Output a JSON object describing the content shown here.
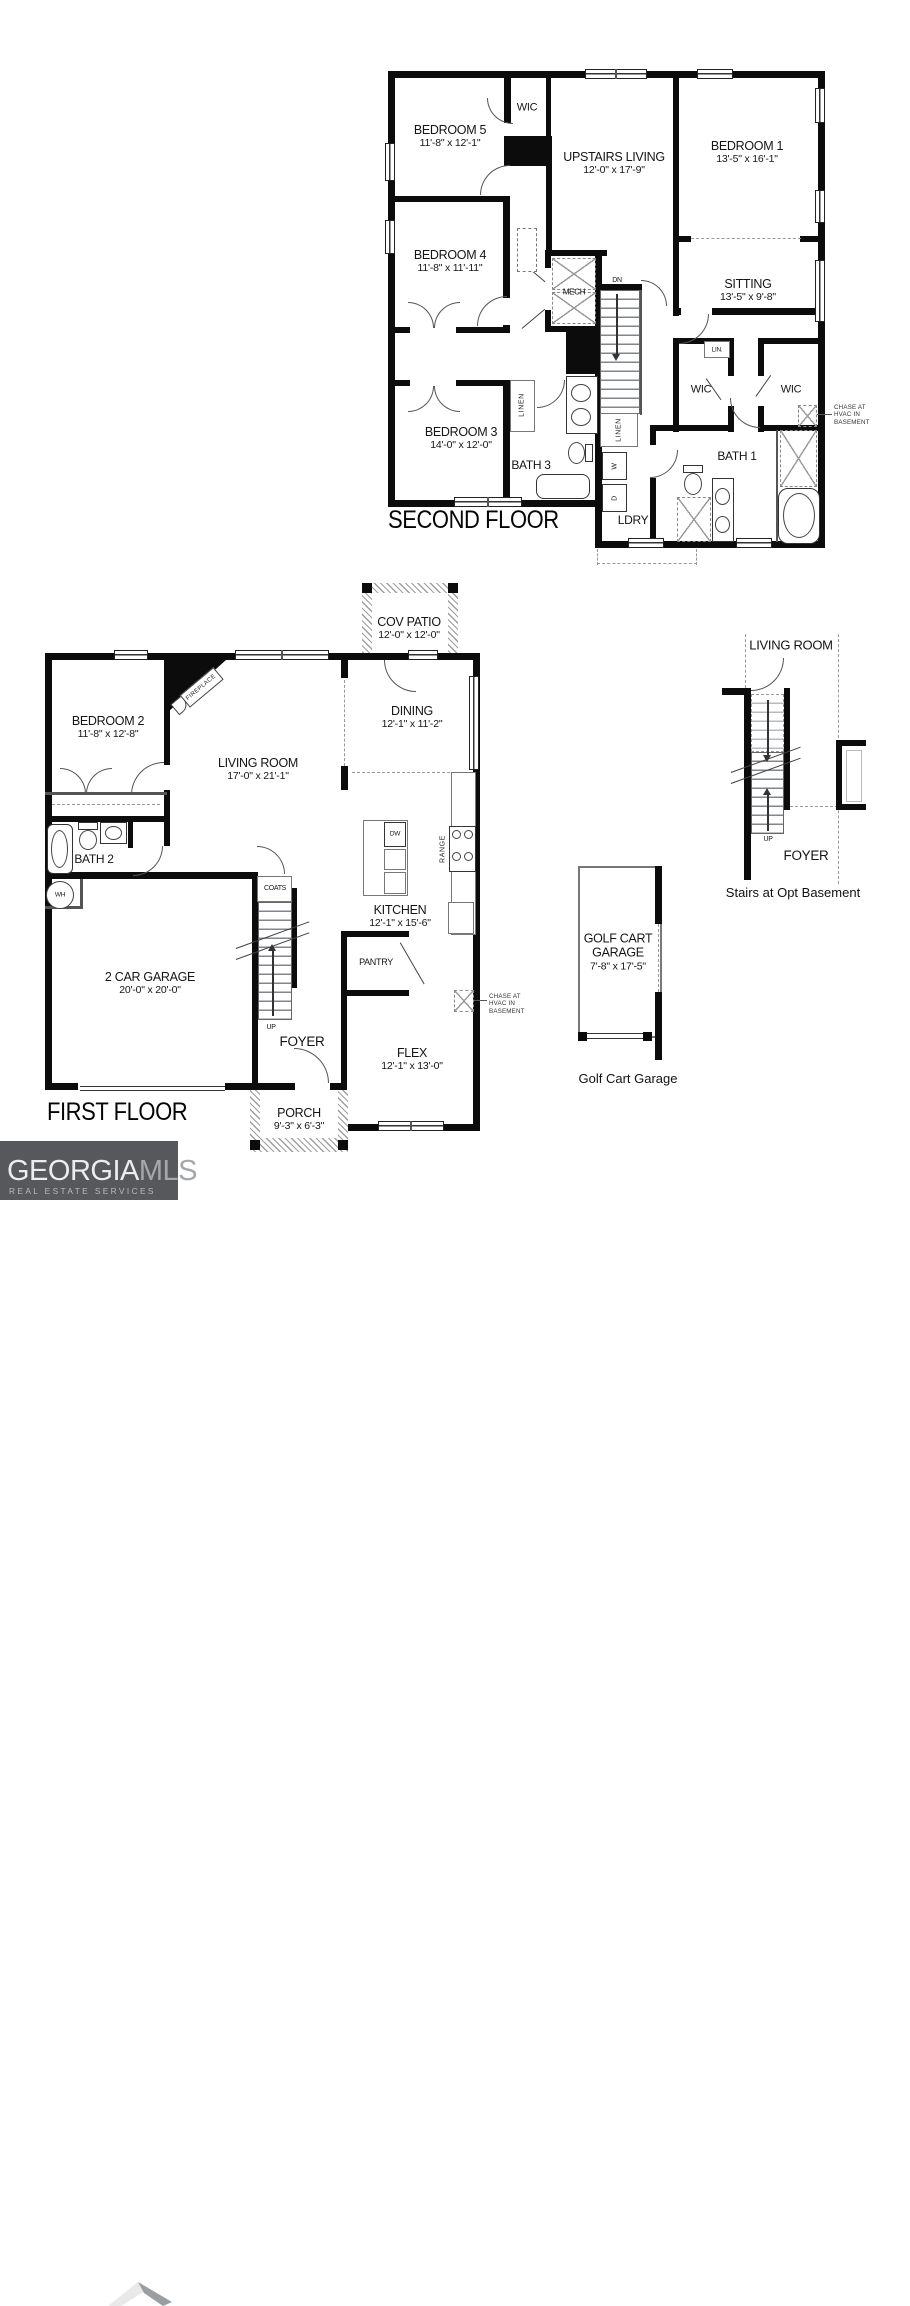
{
  "sf": {
    "title": "SECOND FLOOR",
    "bed5": "BEDROOM 5",
    "bed5_d": "11'-8\" x 12'-1\"",
    "wic": "WIC",
    "living": "UPSTAIRS LIVING",
    "living_d": "12'-0\" x 17'-9\"",
    "bed1": "BEDROOM 1",
    "bed1_d": "13'-5\" x 16'-1\"",
    "bed4": "BEDROOM 4",
    "bed4_d": "11'-8\" x 11'-11\"",
    "sitting": "SITTING",
    "sitting_d": "13'-5\" x 9'-8\"",
    "mech": "MECH",
    "dn": "DN",
    "lin": "LIN.",
    "wic_left": "WIC",
    "wic_right": "WIC",
    "bed3": "BEDROOM 3",
    "bed3_d": "14'-0\" x 12'-0\"",
    "bath3": "BATH 3",
    "bath1": "BATH 1",
    "linen_a": "LINEN",
    "linen_b": "LINEN",
    "ldry": "LDRY",
    "washer": "W",
    "dryer": "D",
    "chase_l1": "CHASE AT",
    "chase_l2": "HVAC IN",
    "chase_l3": "BASEMENT"
  },
  "ff": {
    "title": "FIRST FLOOR",
    "patio": "COV PATIO",
    "patio_d": "12'-0\" x 12'-0\"",
    "bed2": "BEDROOM 2",
    "bed2_d": "11'-8\" x 12'-8\"",
    "fireplace": "FIREPLACE",
    "living": "LIVING ROOM",
    "living_d": "17'-0\" x 21'-1\"",
    "dining": "DINING",
    "dining_d": "12'-1\" x 11'-2\"",
    "bath2": "BATH 2",
    "wh": "WH",
    "kitchen": "KITCHEN",
    "kitchen_d": "12'-1\" x 15'-6\"",
    "dw": "DW",
    "range": "RANGE",
    "pantry": "PANTRY",
    "coats": "COATS",
    "garage": "2 CAR GARAGE",
    "garage_d": "20'-0\" x 20'-0\"",
    "up": "UP",
    "foyer": "FOYER",
    "flex": "FLEX",
    "flex_d": "12'-1\" x 13'-0\"",
    "porch": "PORCH",
    "porch_d": "9'-3\" x 6'-3\"",
    "chase_l1": "CHASE AT",
    "chase_l2": "HVAC IN",
    "chase_l3": "BASEMENT"
  },
  "bs": {
    "living": "LIVING ROOM",
    "up": "UP",
    "foyer": "FOYER",
    "caption": "Stairs at Opt Basement"
  },
  "gc": {
    "line1": "GOLF CART",
    "line2": "GARAGE",
    "dims": "7'-8\" x 17'-5\"",
    "caption": "Golf Cart Garage"
  },
  "logo": {
    "part1": "GEORGIA",
    "part2": "MLS",
    "tagline": "REAL ESTATE SERVICES",
    "bg": "#57585c"
  }
}
